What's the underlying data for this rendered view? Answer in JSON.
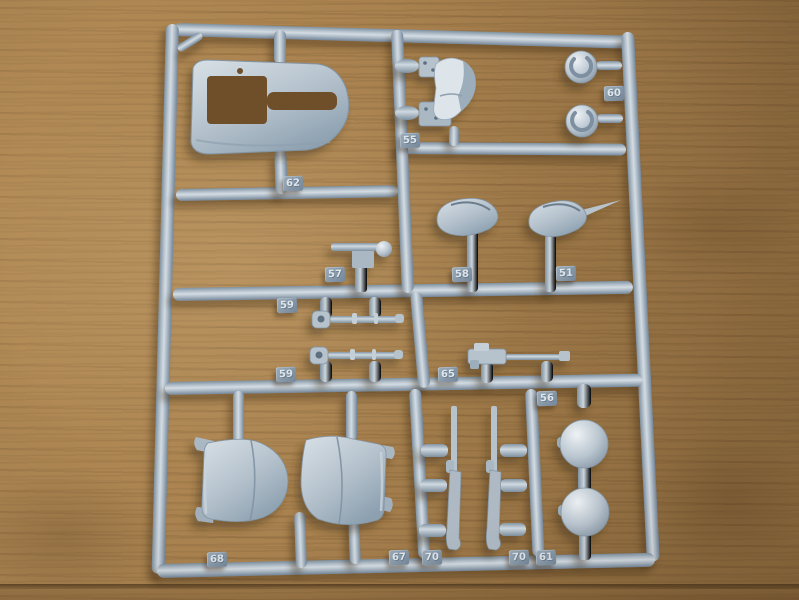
{
  "photo": {
    "subject_name": "plastic-model-kit-sprue-on-wooden-table",
    "palette": {
      "plastic_light": "#d4dce3",
      "plastic_mid": "#b3c0cb",
      "plastic_shadow": "#74869a",
      "tag_face": "#8395a5",
      "wood_mid": "#a9824f",
      "wood_dark": "#6a4b28",
      "shadow": "rgba(60,41,19,0.4)"
    },
    "sprue": {
      "tags": [
        {
          "part_name": "canopy-cowling-part",
          "label": "62"
        },
        {
          "part_name": "seat-part",
          "label": "55"
        },
        {
          "part_name": "wheel-hub-parts",
          "label": "60"
        },
        {
          "part_name": "small-bracket-part",
          "label": "57"
        },
        {
          "part_name": "teardrop-fairing-part",
          "label": "58"
        },
        {
          "part_name": "teardrop-fairing-part",
          "label": "51"
        },
        {
          "part_name": "strut-linkage-part",
          "label": "59"
        },
        {
          "part_name": "strut-linkage-part",
          "label": "59"
        },
        {
          "part_name": "machine-gun-part",
          "label": "65"
        },
        {
          "part_name": "runner-section",
          "label": "56"
        },
        {
          "part_name": "engine-cowling-half",
          "label": "68"
        },
        {
          "part_name": "engine-cowling-half",
          "label": "67"
        },
        {
          "part_name": "rifle-gun-part",
          "label": "70"
        },
        {
          "part_name": "rifle-gun-part",
          "label": "70"
        },
        {
          "part_name": "ball-parts",
          "label": "61"
        }
      ]
    }
  }
}
